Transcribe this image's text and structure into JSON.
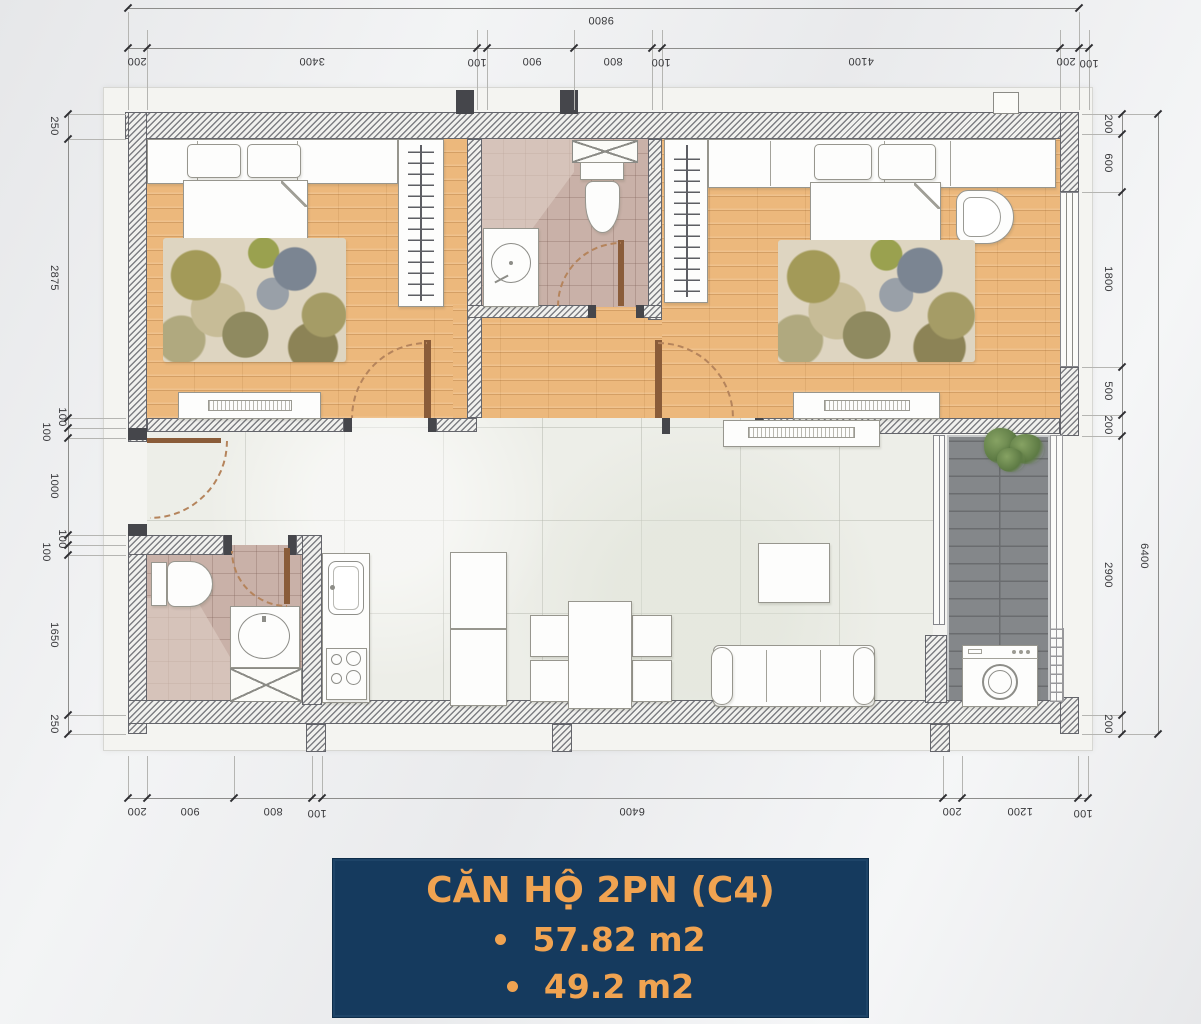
{
  "title_block": {
    "title": "CĂN HỘ 2PN (C4)",
    "bullets": [
      "57.82 m2",
      "49.2 m2"
    ]
  },
  "dimensions": {
    "top_total": "9800",
    "top": [
      "200",
      "3400",
      "100",
      "900",
      "800",
      "100",
      "4100",
      "200",
      "100"
    ],
    "bottom": [
      "200",
      "900",
      "800",
      "100",
      "6400",
      "200",
      "1200",
      "100"
    ],
    "left": [
      "250",
      "2875",
      "100",
      "100",
      "1000",
      "100",
      "100",
      "1650",
      "250"
    ],
    "right": [
      "200",
      "600",
      "1800",
      "500",
      "200",
      "2900",
      "200"
    ],
    "right_total": "6400"
  },
  "colors": {
    "accent_navy": "#153a5e",
    "accent_orange": "#f0a351",
    "wood_floor": "#ecb87c",
    "bath_tile": "#c9b1a8",
    "deck_gray": "#84878a"
  }
}
